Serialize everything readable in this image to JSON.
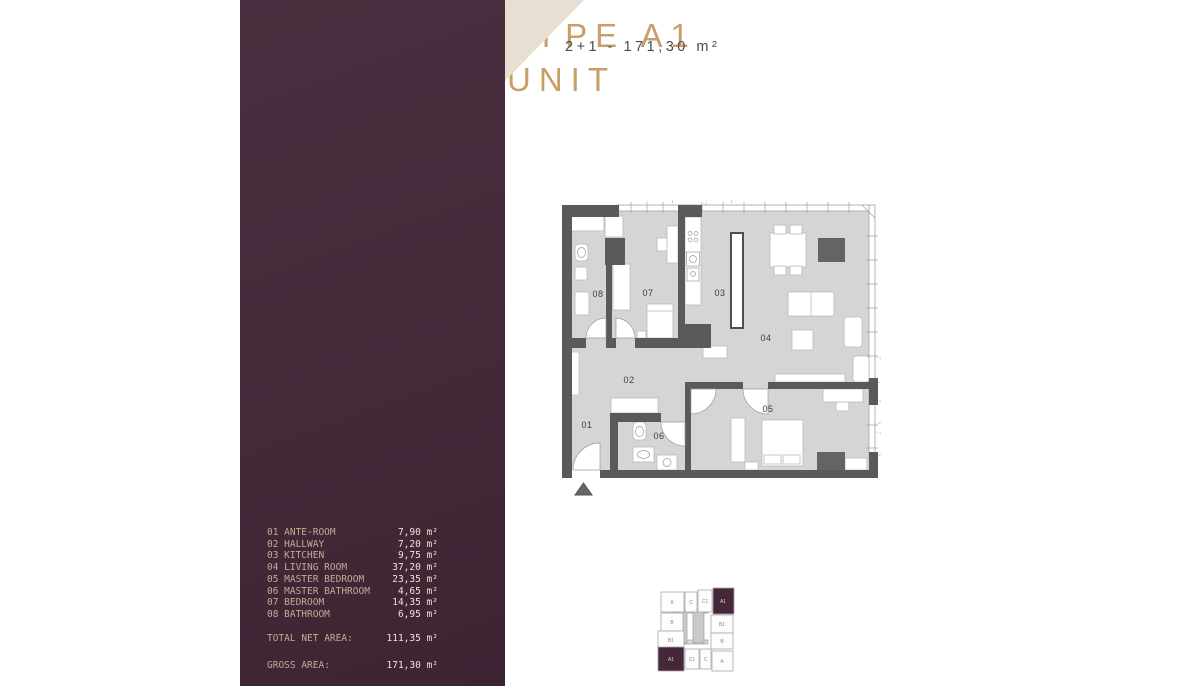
{
  "header": {
    "unit_spec": "2+1 - 171,30 m²"
  },
  "panel": {
    "title_line1": "TYPE A1",
    "title_line2": "UNIT",
    "rooms": [
      {
        "number": "01",
        "name": "ANTE-ROOM",
        "area": "7,90 m²"
      },
      {
        "number": "02",
        "name": "HALLWAY",
        "area": "7,20 m²"
      },
      {
        "number": "03",
        "name": "KITCHEN",
        "area": "9,75 m²"
      },
      {
        "number": "04",
        "name": "LIVING ROOM",
        "area": "37,20 m²"
      },
      {
        "number": "05",
        "name": "MASTER BEDROOM",
        "area": "23,35 m²"
      },
      {
        "number": "06",
        "name": "MASTER BATHROOM",
        "area": "4,65 m²"
      },
      {
        "number": "07",
        "name": "BEDROOM",
        "area": "14,35 m²"
      },
      {
        "number": "08",
        "name": "BATHROOM",
        "area": "6,95 m²"
      }
    ],
    "totals": [
      {
        "label": "TOTAL NET AREA:",
        "value": "111,35 m²"
      },
      {
        "label": "GROSS AREA:",
        "value": "171,30 m²"
      }
    ]
  },
  "key_plan": {
    "units": [
      "A",
      "C",
      "C1",
      "A1",
      "B",
      "B1",
      "B1",
      "B",
      "A1",
      "C1",
      "C",
      "A"
    ]
  },
  "colors": {
    "panel_maroon": "#442939",
    "gold": "#c89e6a",
    "beige": "#e7dfd2",
    "wall_gray": "#5a5a5a",
    "floor_gray": "#d5d5d5"
  }
}
